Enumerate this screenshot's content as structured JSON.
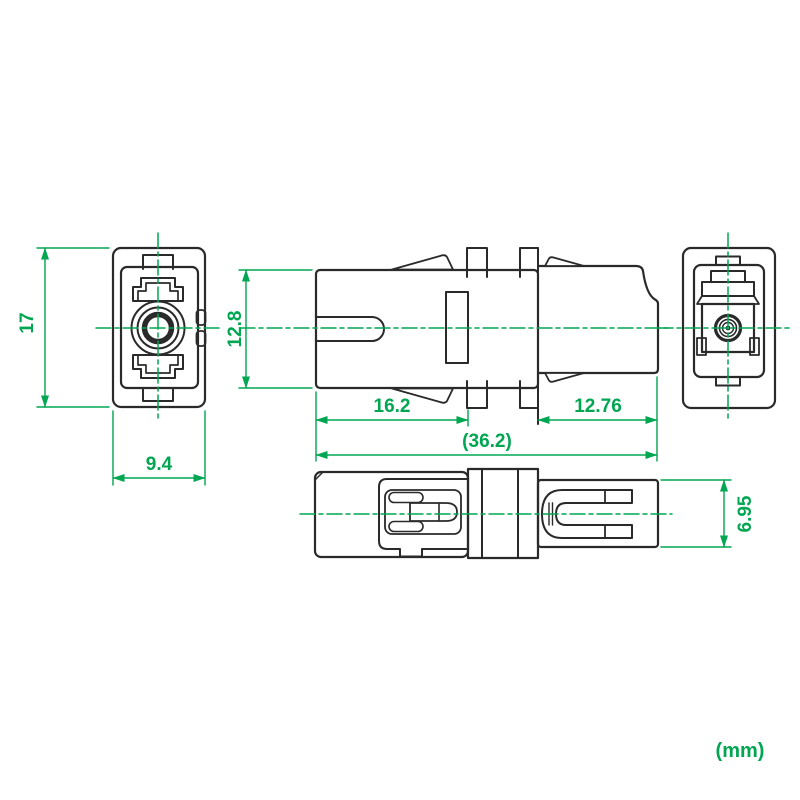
{
  "drawing": {
    "units_label": "(mm)",
    "colors": {
      "dimension_green": "#00a651",
      "line_black": "#2a2a2a",
      "background": "#ffffff"
    },
    "views": {
      "front_view": {
        "dims": {
          "height": "17",
          "width": "9.4"
        }
      },
      "side_view": {
        "dims": {
          "body_height": "12.8",
          "front_length": "16.2",
          "rear_length": "12.76",
          "overall_length": "(36.2)"
        }
      },
      "rear_view": {
        "dims": {}
      },
      "top_view": {
        "dims": {
          "rear_width": "6.95"
        }
      }
    }
  }
}
